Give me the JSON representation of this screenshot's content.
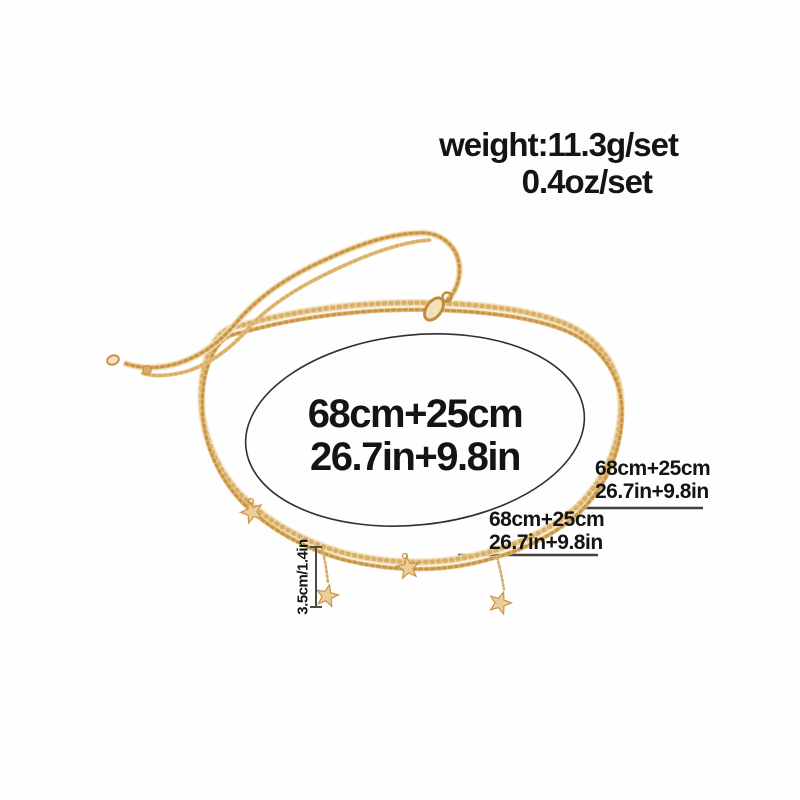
{
  "image_type": "product measurement photo",
  "product": "layered gold chain belly/waist necklace set with star charms",
  "labels": {
    "weight": {
      "line1": "weight:11.3g/set",
      "line2": "0.4oz/set"
    },
    "center_measurement": {
      "line1": "68cm+25cm",
      "line2": "26.7in+9.8in"
    },
    "note_upper": {
      "line1": "68cm+25cm",
      "line2": "26.7in+9.8in"
    },
    "note_lower": {
      "line1": "68cm+25cm",
      "line2": "26.7in+9.8in"
    },
    "drop_length": "3.5cm/1.4in"
  },
  "icons": {
    "star_charm": "★",
    "lobster_clasp": "clasp",
    "measurement_bracket": "I",
    "measurement_ellipse": "oval outline"
  },
  "colors": {
    "background": "#fefefe",
    "text": "#141414",
    "annotation_line": "#424242",
    "ellipse_stroke": "#2f2f2f",
    "gold_light": "#f3e3c3",
    "gold_mid": "#e6c384",
    "gold_deep": "#d9ae66",
    "gold_shadow": "#c89447"
  }
}
